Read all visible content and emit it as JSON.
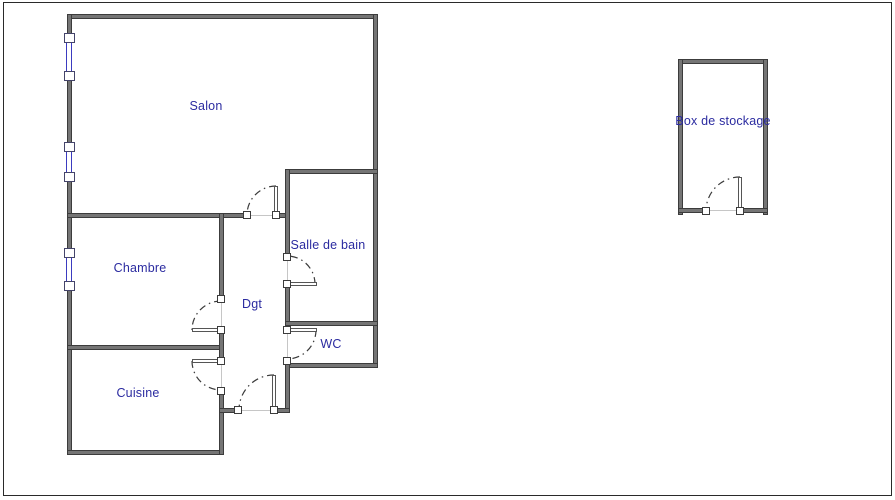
{
  "canvas": {
    "width": 895,
    "height": 500
  },
  "colors": {
    "background": "#ffffff",
    "frame": "#2a2a2a",
    "wall_core": "#757575",
    "wall_edge": "#3c3c3c",
    "leaf_edge": "#555555",
    "threshold": "#c6c6c6",
    "window_blue": "#3b3bc0",
    "arc": "#3a3a3a",
    "label": "#2b2ba0"
  },
  "rooms": [
    {
      "id": "salon",
      "label": "Salon",
      "cx": 206,
      "cy": 106
    },
    {
      "id": "chambre",
      "label": "Chambre",
      "cx": 140,
      "cy": 268
    },
    {
      "id": "cuisine",
      "label": "Cuisine",
      "cx": 138,
      "cy": 393
    },
    {
      "id": "degagement",
      "label": "Dgt",
      "cx": 252,
      "cy": 304
    },
    {
      "id": "salle-de-bain",
      "label": "Salle de bain",
      "cx": 328,
      "cy": 245
    },
    {
      "id": "wc",
      "label": "WC",
      "cx": 331,
      "cy": 344
    },
    {
      "id": "box-stockage",
      "label": "Box de stockage",
      "cx": 723,
      "cy": 121
    }
  ],
  "walls": [
    {
      "name": "apartment-top-wall",
      "x": 67,
      "y": 14,
      "w": 311,
      "h": 5
    },
    {
      "name": "apartment-left-wall",
      "x": 67,
      "y": 14,
      "w": 5,
      "h": 441
    },
    {
      "name": "apartment-right-wall",
      "x": 373,
      "y": 14,
      "w": 5,
      "h": 353
    },
    {
      "name": "salon-bottom-wall",
      "x": 67,
      "y": 213,
      "w": 180,
      "h": 5
    },
    {
      "name": "salon-bottom-stub",
      "x": 274,
      "y": 213,
      "w": 15,
      "h": 5
    },
    {
      "name": "bathroom-top-wall",
      "x": 285,
      "y": 169,
      "w": 93,
      "h": 5
    },
    {
      "name": "bathroom-left-wall-upper",
      "x": 285,
      "y": 169,
      "w": 5,
      "h": 88
    },
    {
      "name": "bathroom-left-wall-lower",
      "x": 285,
      "y": 284,
      "w": 5,
      "h": 46
    },
    {
      "name": "bathroom-wc-divider-wall",
      "x": 285,
      "y": 321,
      "w": 93,
      "h": 5
    },
    {
      "name": "wc-bottom-wall",
      "x": 285,
      "y": 363,
      "w": 93,
      "h": 5
    },
    {
      "name": "entry-right-wall",
      "x": 285,
      "y": 361,
      "w": 5,
      "h": 51
    },
    {
      "name": "chambre-cuisine-wall",
      "x": 67,
      "y": 345,
      "w": 157,
      "h": 5
    },
    {
      "name": "cuisine-bottom-wall",
      "x": 67,
      "y": 450,
      "w": 157,
      "h": 5
    },
    {
      "name": "hall-left-wall-upper",
      "x": 219,
      "y": 213,
      "w": 5,
      "h": 86
    },
    {
      "name": "hall-left-wall-middle",
      "x": 219,
      "y": 330,
      "w": 5,
      "h": 31
    },
    {
      "name": "hall-left-wall-lower",
      "x": 219,
      "y": 391,
      "w": 5,
      "h": 64
    },
    {
      "name": "entry-left-stub",
      "x": 219,
      "y": 408,
      "w": 17,
      "h": 5
    },
    {
      "name": "entry-right-stub",
      "x": 272,
      "y": 408,
      "w": 18,
      "h": 5
    },
    {
      "name": "box-top-wall",
      "x": 678,
      "y": 59,
      "w": 90,
      "h": 5
    },
    {
      "name": "box-left-wall",
      "x": 678,
      "y": 59,
      "w": 5,
      "h": 156
    },
    {
      "name": "box-right-wall",
      "x": 763,
      "y": 59,
      "w": 5,
      "h": 156
    },
    {
      "name": "box-bottom-wall-left",
      "x": 678,
      "y": 208,
      "w": 28,
      "h": 5
    },
    {
      "name": "box-bottom-wall-right",
      "x": 738,
      "y": 208,
      "w": 30,
      "h": 5
    }
  ],
  "door_jambs": [
    {
      "name": "salon-door-jamb-left",
      "cx": 247,
      "cy": 215
    },
    {
      "name": "salon-door-jamb-hinge",
      "cx": 276,
      "cy": 215
    },
    {
      "name": "chambre-door-jamb-top",
      "cx": 221,
      "cy": 299
    },
    {
      "name": "chambre-door-jamb-hinge",
      "cx": 221,
      "cy": 330
    },
    {
      "name": "cuisine-door-jamb-hinge",
      "cx": 221,
      "cy": 361
    },
    {
      "name": "cuisine-door-jamb-bottom",
      "cx": 221,
      "cy": 391
    },
    {
      "name": "entry-door-jamb-left",
      "cx": 238,
      "cy": 410
    },
    {
      "name": "entry-door-jamb-hinge",
      "cx": 274,
      "cy": 410
    },
    {
      "name": "bath-door-jamb-top",
      "cx": 287,
      "cy": 257
    },
    {
      "name": "bath-door-jamb-hinge",
      "cx": 287,
      "cy": 284
    },
    {
      "name": "wc-door-jamb-hinge",
      "cx": 287,
      "cy": 330
    },
    {
      "name": "wc-door-jamb-bottom",
      "cx": 287,
      "cy": 361
    },
    {
      "name": "box-door-jamb-left",
      "cx": 706,
      "cy": 211
    },
    {
      "name": "box-door-jamb-hinge",
      "cx": 740,
      "cy": 211
    }
  ],
  "door_leaves": [
    {
      "name": "salon-door-leaf",
      "x": 274,
      "y": 186,
      "w": 4,
      "h": 29
    },
    {
      "name": "chambre-door-leaf",
      "x": 192,
      "y": 328,
      "w": 29,
      "h": 4
    },
    {
      "name": "cuisine-door-leaf",
      "x": 192,
      "y": 359,
      "w": 29,
      "h": 4
    },
    {
      "name": "entry-door-leaf",
      "x": 272,
      "y": 375,
      "w": 4,
      "h": 35
    },
    {
      "name": "bath-door-leaf",
      "x": 289,
      "y": 282,
      "w": 28,
      "h": 4
    },
    {
      "name": "wc-door-leaf",
      "x": 289,
      "y": 328,
      "w": 28,
      "h": 4
    },
    {
      "name": "box-door-leaf",
      "x": 738,
      "y": 177,
      "w": 4,
      "h": 34
    }
  ],
  "door_arcs": [
    {
      "name": "salon-door-arc",
      "d": "M 276 186 A 29 29 0 0 0 247 215"
    },
    {
      "name": "chambre-door-arc",
      "d": "M 221 301 A 29 29 0 0 0 192 330"
    },
    {
      "name": "cuisine-door-arc",
      "d": "M 192 361 A 29 29 0 0 0 221 390"
    },
    {
      "name": "entry-door-arc",
      "d": "M 274 375 A 35 35 0 0 0 239 410"
    },
    {
      "name": "bath-door-arc",
      "d": "M 315 284 A 28 28 0 0 0 287 256"
    },
    {
      "name": "wc-door-arc",
      "d": "M 316 330 A 29 29 0 0 1 287 359"
    },
    {
      "name": "box-door-arc",
      "d": "M 740 177 A 34 34 0 0 0 706 211"
    }
  ],
  "thresholds": [
    {
      "name": "salon-door-threshold",
      "x": 247,
      "y": 215,
      "w": 29,
      "h": 1
    },
    {
      "name": "chambre-door-threshold",
      "x": 221,
      "y": 301,
      "w": 1,
      "h": 27
    },
    {
      "name": "cuisine-door-threshold",
      "x": 221,
      "y": 363,
      "w": 1,
      "h": 26
    },
    {
      "name": "entry-door-threshold",
      "x": 240,
      "y": 410,
      "w": 32,
      "h": 1
    },
    {
      "name": "bath-door-threshold",
      "x": 287,
      "y": 259,
      "w": 1,
      "h": 23
    },
    {
      "name": "wc-door-threshold",
      "x": 287,
      "y": 332,
      "w": 1,
      "h": 27
    },
    {
      "name": "box-door-threshold",
      "x": 708,
      "y": 210,
      "w": 30,
      "h": 1
    }
  ],
  "windows": [
    {
      "name": "salon-window-upper",
      "cx": 69,
      "top": 33,
      "bottom": 81
    },
    {
      "name": "salon-window-lower",
      "cx": 69,
      "top": 142,
      "bottom": 182
    },
    {
      "name": "chambre-window",
      "cx": 69,
      "top": 248,
      "bottom": 291
    }
  ]
}
